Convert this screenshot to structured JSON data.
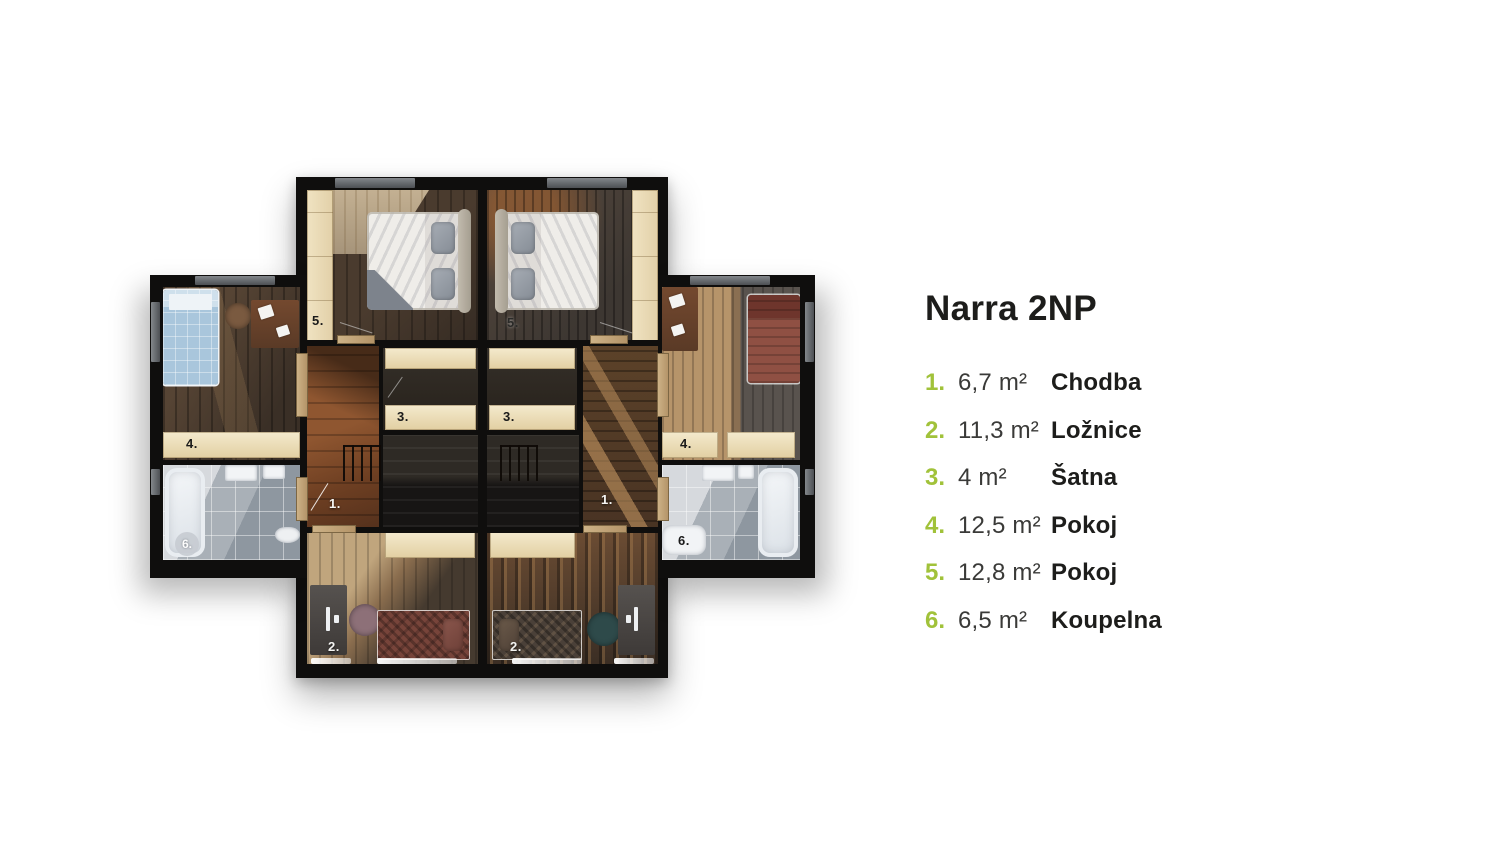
{
  "panel": {
    "title": "Narra 2NP",
    "items": [
      {
        "num": "1.",
        "area": "6,7 m²",
        "name": "Chodba"
      },
      {
        "num": "2.",
        "area": "11,3 m²",
        "name": "Ložnice"
      },
      {
        "num": "3.",
        "area": "4 m²",
        "name": "Šatna"
      },
      {
        "num": "4.",
        "area": "12,5 m²",
        "name": "Pokoj"
      },
      {
        "num": "5.",
        "area": "12,8 m²",
        "name": "Pokoj"
      },
      {
        "num": "6.",
        "area": "6,5 m²",
        "name": "Koupelna"
      }
    ]
  },
  "plan": {
    "labels": {
      "chodba": "1.",
      "loznice": "2.",
      "satna": "3.",
      "pokoj4": "4.",
      "pokoj5": "5.",
      "koupelna": "6."
    }
  },
  "colors": {
    "accent_green": "#a1c23a",
    "title_text": "#1d1d1b",
    "area_text": "#3a3a38",
    "wall": "#0f0e0d"
  }
}
